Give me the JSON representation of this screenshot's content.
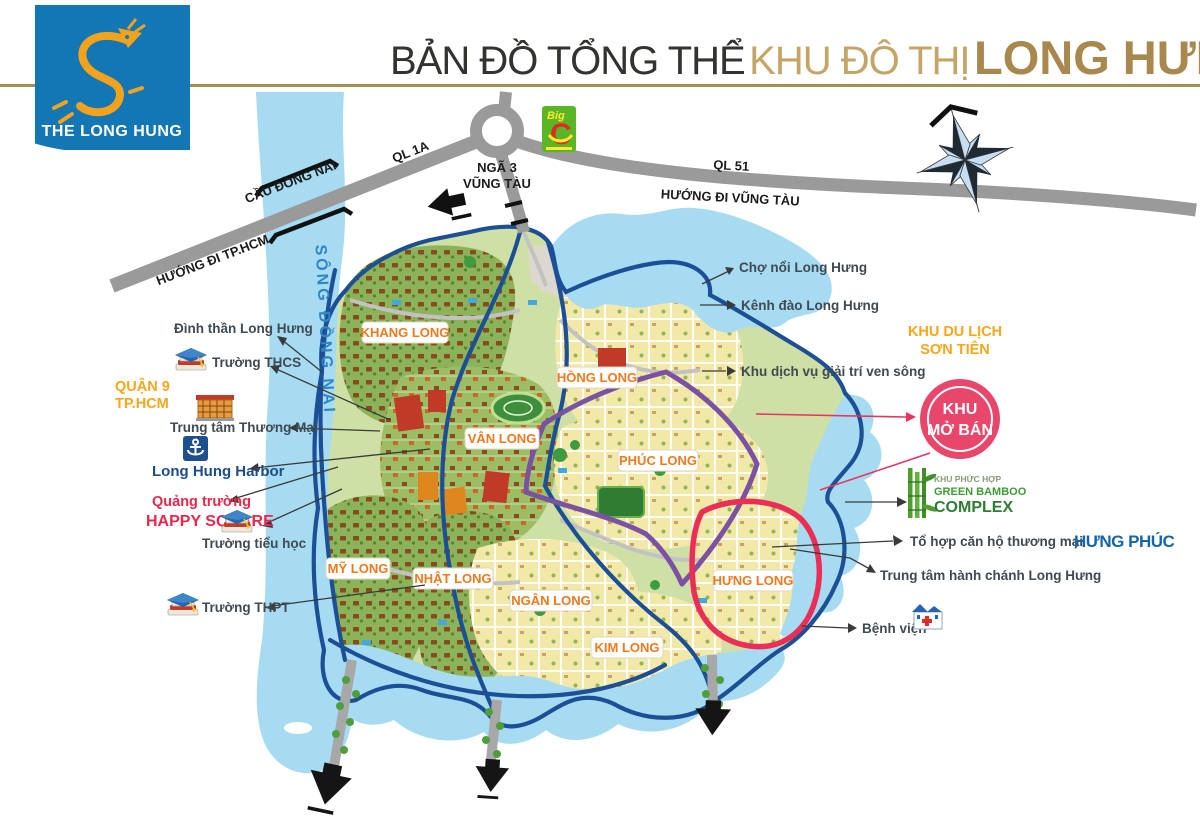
{
  "header": {
    "logo": {
      "brand": "THE LONG HUNG",
      "bg_color": "#1277b4",
      "dragon_color": "#f2a21d"
    },
    "title": {
      "part1": "BẢN ĐỒ TỔNG THỂ",
      "part2": "KHU ĐÔ THỊ",
      "part3": "LONG HƯNG",
      "part1_color": "#34332f",
      "part2_color": "#c5a566",
      "part3_color": "#a8884c",
      "rule_color": "#a58d55"
    }
  },
  "map": {
    "river_label": "SÔNG ĐỒNG NAI",
    "roads": {
      "ql1a": "QL 1A",
      "cau_dong_nai": "CẦU ĐỒNG NAI",
      "huong_tphcm": "HƯỚNG ĐI TP.HCM",
      "nga3_l1": "NGÃ 3",
      "nga3_l2": "VŨNG TÀU",
      "ql51": "QL 51",
      "huong_vungtau": "HƯỚNG ĐI VŨNG TÀU"
    },
    "districts": [
      "KHANG LONG",
      "HỒNG LONG",
      "VÂN LONG",
      "PHÚC LONG",
      "MỸ LONG",
      "NHẬT LONG",
      "NGÂN LONG",
      "KIM LONG",
      "HƯNG LONG"
    ],
    "colors": {
      "water": "#a6dbf2",
      "land": "#cfe0a6",
      "boundary_navy": "#1c4f96",
      "road_gray": "#9a9a9a",
      "purple_road": "#7b52a1",
      "red_border": "#ec2d55",
      "district_chip_text": "#f2791b",
      "river_text": "#2f86c3"
    }
  },
  "callouts_left": {
    "dinh_than": "Đình thần Long Hưng",
    "truong_thcs": "Trường THCS",
    "quan9_l1": "QUẬN 9",
    "quan9_l2": "TP.HCM",
    "trung_tam_thuong_mai": "Trung tâm Thương Mại",
    "harbor": "Long Hung Harbor",
    "quang_truong_l1": "Quảng trường",
    "quang_truong_l2": "HAPPY SQUARE",
    "truong_tieu_hoc": "Trường tiểu học",
    "truong_thpt": "Trường THPT"
  },
  "callouts_right": {
    "cho_noi": "Chợ nổi Long Hưng",
    "kenh_dao": "Kênh đào Long Hưng",
    "son_tien_l1": "KHU DU LỊCH",
    "son_tien_l2": "SƠN TIÊN",
    "khu_dich_vu": "Khu dịch vụ giải trí ven sông",
    "khu_mo_ban_l1": "KHU",
    "khu_mo_ban_l2": "MỞ BÁN",
    "bamboo_l1": "KHU PHỨC HỢP",
    "bamboo_l2": "GREEN BAMBOO",
    "bamboo_l3": "COMPLEX",
    "to_hop_can_ho": "Tổ hợp căn hộ thương mại",
    "hung_phuc": "HƯNG PHÚC",
    "hanh_chanh": "Trung tâm hành chánh Long Hưng",
    "benh_vien": "Bệnh viện"
  },
  "landmarks": {
    "big_c_l1": "Big",
    "big_c_l2": "C",
    "khu_mo_ban_color": "#e8476b"
  }
}
